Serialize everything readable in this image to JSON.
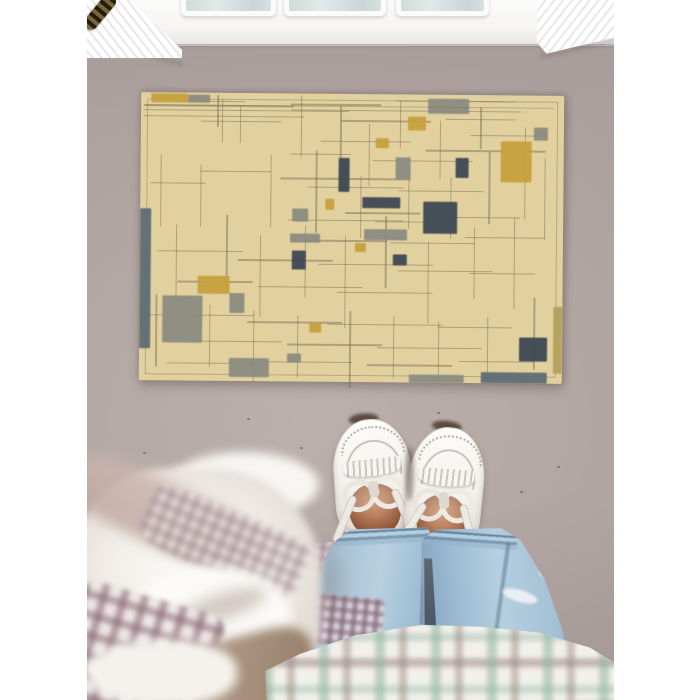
{
  "scene": {
    "description": "Top-down photo: person wearing white leather boat shoes with bow laces and rolled light-blue jeans stands on a taupe floor before a tan Mondrian-style area rug with gray, navy and mustard blocks; a white paneled door with glass panes and fluted casing is at top; a blurred white duvet with mauve plaid sits at bottom-left and a white/teal/brown plaid fabric drapes across the bottom.",
    "visible_text": "none"
  },
  "palette": {
    "margin_white": "#ffffff",
    "floor": "#b5a9a6",
    "floor_dark": "#aba09d",
    "door_white": "#fbfbfa",
    "glass": "#cfdbda",
    "hinge_brass": "#7a6636",
    "rug_tan": "#e2d19f",
    "rug_line": "#7a6f54",
    "mustard": "#c7a13d",
    "gray": "#8b8c81",
    "navy": "#3e4955",
    "slate": "#5e6c74",
    "khaki": "#b5a15e",
    "denim_light": "#b8d0e0",
    "denim_dark": "#7d9cb8",
    "skin": "#b67f5d",
    "shoe_white": "#f5f3ef",
    "blanket_white": "#f6f4f1",
    "blanket_mauve": "#c8b2ab",
    "plaid_teal": "#8fb4a1",
    "plaid_brown": "#96807c",
    "gingham_mauve": "#987686"
  },
  "door": {
    "panes": [
      {
        "x": 100,
        "w": 83
      },
      {
        "x": 203,
        "w": 90
      },
      {
        "x": 315,
        "w": 81
      }
    ]
  },
  "rug": {
    "x": 53,
    "y": 94,
    "w": 423,
    "h": 288,
    "blocks": [
      {
        "x": 10,
        "y": 1,
        "w": 37,
        "h": 9,
        "c": "m"
      },
      {
        "x": 47,
        "y": 2,
        "w": 22,
        "h": 8,
        "c": "g"
      },
      {
        "x": 287,
        "y": 4,
        "w": 41,
        "h": 15,
        "c": "g"
      },
      {
        "x": 267,
        "y": 22,
        "w": 18,
        "h": 14,
        "c": "m"
      },
      {
        "x": 393,
        "y": 32,
        "w": 14,
        "h": 13,
        "c": "g"
      },
      {
        "x": 360,
        "y": 46,
        "w": 31,
        "h": 41,
        "c": "m"
      },
      {
        "x": 235,
        "y": 44,
        "w": 13,
        "h": 10,
        "c": "m"
      },
      {
        "x": 198,
        "y": 64,
        "w": 11,
        "h": 34,
        "c": "n"
      },
      {
        "x": 255,
        "y": 63,
        "w": 15,
        "h": 22,
        "c": "g"
      },
      {
        "x": 315,
        "y": 63,
        "w": 13,
        "h": 20,
        "c": "n"
      },
      {
        "x": 222,
        "y": 103,
        "w": 38,
        "h": 11,
        "c": "n"
      },
      {
        "x": 283,
        "y": 107,
        "w": 34,
        "h": 32,
        "c": "n"
      },
      {
        "x": 185,
        "y": 105,
        "w": 9,
        "h": 11,
        "c": "m"
      },
      {
        "x": 152,
        "y": 115,
        "w": 16,
        "h": 13,
        "c": "g"
      },
      {
        "x": 150,
        "y": 140,
        "w": 30,
        "h": 9,
        "c": "g"
      },
      {
        "x": 224,
        "y": 135,
        "w": 43,
        "h": 11,
        "c": "g"
      },
      {
        "x": 152,
        "y": 157,
        "w": 14,
        "h": 19,
        "c": "n"
      },
      {
        "x": 215,
        "y": 149,
        "w": 11,
        "h": 9,
        "c": "m"
      },
      {
        "x": 253,
        "y": 160,
        "w": 14,
        "h": 11,
        "c": "n"
      },
      {
        "x": 58,
        "y": 183,
        "w": 32,
        "h": 18,
        "c": "m"
      },
      {
        "x": 90,
        "y": 200,
        "w": 15,
        "h": 20,
        "c": "g"
      },
      {
        "x": 23,
        "y": 203,
        "w": 40,
        "h": 47,
        "c": "g"
      },
      {
        "x": 170,
        "y": 229,
        "w": 12,
        "h": 10,
        "c": "m"
      },
      {
        "x": 380,
        "y": 242,
        "w": 28,
        "h": 24,
        "c": "n"
      },
      {
        "x": 148,
        "y": 260,
        "w": 14,
        "h": 9,
        "c": "g"
      },
      {
        "x": 90,
        "y": 265,
        "w": 40,
        "h": 19,
        "c": "g"
      },
      {
        "x": 0,
        "y": 116,
        "w": 11,
        "h": 140,
        "c": "s"
      },
      {
        "x": 414,
        "y": 211,
        "w": 9,
        "h": 67,
        "c": "k"
      },
      {
        "x": 342,
        "y": 277,
        "w": 66,
        "h": 11,
        "c": "s"
      },
      {
        "x": 270,
        "y": 280,
        "w": 55,
        "h": 8,
        "c": "g"
      }
    ],
    "h_lines": [
      [
        3,
        12,
        150
      ],
      [
        3,
        17,
        205
      ],
      [
        3,
        23,
        160
      ],
      [
        34,
        8,
        70
      ],
      [
        150,
        10,
        90
      ],
      [
        255,
        6,
        120
      ],
      [
        150,
        16,
        230
      ],
      [
        60,
        28,
        80
      ],
      [
        200,
        26,
        90
      ],
      [
        305,
        24,
        70
      ],
      [
        330,
        40,
        70
      ],
      [
        180,
        47,
        90
      ],
      [
        285,
        55,
        120
      ],
      [
        150,
        60,
        60
      ],
      [
        232,
        66,
        100
      ],
      [
        60,
        78,
        70
      ],
      [
        140,
        84,
        130
      ],
      [
        10,
        90,
        55
      ],
      [
        168,
        93,
        95
      ],
      [
        258,
        96,
        85
      ],
      [
        205,
        118,
        75
      ],
      [
        148,
        126,
        115
      ],
      [
        235,
        127,
        65
      ],
      [
        305,
        122,
        75
      ],
      [
        152,
        146,
        95
      ],
      [
        250,
        148,
        85
      ],
      [
        325,
        142,
        80
      ],
      [
        18,
        158,
        85
      ],
      [
        98,
        166,
        95
      ],
      [
        178,
        170,
        115
      ],
      [
        258,
        176,
        95
      ],
      [
        330,
        178,
        65
      ],
      [
        38,
        188,
        75
      ],
      [
        118,
        193,
        105
      ],
      [
        198,
        198,
        95
      ],
      [
        10,
        222,
        105
      ],
      [
        108,
        228,
        95
      ],
      [
        188,
        230,
        115
      ],
      [
        298,
        232,
        75
      ],
      [
        58,
        248,
        85
      ],
      [
        148,
        250,
        95
      ],
      [
        238,
        253,
        105
      ],
      [
        28,
        270,
        95
      ],
      [
        128,
        268,
        85
      ],
      [
        228,
        270,
        85
      ],
      [
        320,
        266,
        75
      ]
    ],
    "v_lines": [
      [
        76,
        2,
        32
      ],
      [
        81,
        6,
        44
      ],
      [
        99,
        12,
        38
      ],
      [
        160,
        2,
        62
      ],
      [
        199,
        12,
        52
      ],
      [
        228,
        30,
        62
      ],
      [
        259,
        6,
        48
      ],
      [
        299,
        26,
        58
      ],
      [
        339,
        12,
        42
      ],
      [
        20,
        62,
        72
      ],
      [
        60,
        72,
        62
      ],
      [
        130,
        62,
        72
      ],
      [
        175,
        57,
        82
      ],
      [
        220,
        82,
        62
      ],
      [
        268,
        62,
        72
      ],
      [
        310,
        82,
        62
      ],
      [
        348,
        57,
        72
      ],
      [
        384,
        32,
        92
      ],
      [
        404,
        62,
        82
      ],
      [
        36,
        132,
        82
      ],
      [
        86,
        122,
        72
      ],
      [
        120,
        142,
        82
      ],
      [
        165,
        132,
        72
      ],
      [
        205,
        142,
        92
      ],
      [
        245,
        122,
        72
      ],
      [
        288,
        147,
        82
      ],
      [
        334,
        132,
        72
      ],
      [
        374,
        122,
        92
      ],
      [
        16,
        202,
        72
      ],
      [
        70,
        212,
        62
      ],
      [
        114,
        217,
        72
      ],
      [
        158,
        222,
        62
      ],
      [
        210,
        217,
        77
      ],
      [
        254,
        222,
        62
      ],
      [
        299,
        227,
        62
      ],
      [
        348,
        222,
        57
      ],
      [
        394,
        202,
        72
      ]
    ]
  },
  "floor_specks": [
    [
      56,
      452
    ],
    [
      88,
      470
    ],
    [
      213,
      447
    ],
    [
      281,
      476
    ],
    [
      433,
      491
    ],
    [
      350,
      412
    ],
    [
      160,
      418
    ],
    [
      470,
      466
    ]
  ],
  "blanket_parts": [
    {
      "n": "shadow-on-floor",
      "l": 218,
      "t": 60,
      "w": 60,
      "h": 150,
      "r": 0,
      "rad": "50%",
      "bg": "radial-gradient(50% 50% at 50% 50%, rgba(130,115,108,.45), rgba(130,115,108,0) 70%)",
      "blur": 9,
      "op": 1
    },
    {
      "n": "top-roll",
      "l": 88,
      "t": 4,
      "w": 150,
      "h": 66,
      "r": 0,
      "rad": "50%",
      "bg": "#f8f6f3",
      "blur": 5,
      "op": 1
    },
    {
      "n": "main-mass",
      "l": -10,
      "t": 20,
      "w": 250,
      "h": 240,
      "r": 0,
      "rad": "40% 45% 35% 40%",
      "bg": "radial-gradient(55% 50% at 48% 42%, #fcfbf9, #f1ede8 60%, #e2dbd4)",
      "blur": 4,
      "op": 1
    },
    {
      "n": "mauve-band",
      "l": -14,
      "t": 36,
      "w": 200,
      "h": 64,
      "r": 25,
      "rad": "30%",
      "bg": "linear-gradient(#cdb7b0,#bfa89f)",
      "blur": 7,
      "op": 0.85
    },
    {
      "n": "gingham-band",
      "l": 60,
      "t": 62,
      "w": 168,
      "h": 64,
      "r": 23,
      "rad": "20%",
      "bg": "repeating-linear-gradient(90deg, rgba(135,105,118,.5) 0 6px, rgba(0,0,0,0) 6px 13px), repeating-linear-gradient(0deg, rgba(135,105,118,.45) 0 6px, rgba(0,0,0,0) 6px 13px), linear-gradient(#eee8e5,#eee8e5)",
      "blur": 3,
      "op": 0.8
    },
    {
      "n": "fold-highlight",
      "l": 50,
      "t": 118,
      "w": 160,
      "h": 96,
      "r": 0,
      "rad": "50%",
      "bg": "#fbfaf7",
      "blur": 5,
      "op": 1
    },
    {
      "n": "fold-shadow",
      "l": 92,
      "t": 146,
      "w": 96,
      "h": 26,
      "r": -18,
      "rad": "50%",
      "bg": "#c9beb5",
      "blur": 7,
      "op": 0.8
    },
    {
      "n": "burgundy-plaid",
      "l": -16,
      "t": 148,
      "w": 150,
      "h": 118,
      "r": 16,
      "rad": "12%",
      "bg": "repeating-linear-gradient(90deg, rgba(125,88,104,.55) 0 8px, rgba(0,0,0,0) 8px 20px), repeating-linear-gradient(0deg, rgba(125,88,104,.5) 0 8px, rgba(0,0,0,0) 8px 20px), linear-gradient(#ece5e4,#ece5e4)",
      "blur": 2.5,
      "op": 0.92
    },
    {
      "n": "tan-strip",
      "l": 108,
      "t": 186,
      "w": 128,
      "h": 78,
      "r": -14,
      "rad": "30%",
      "bg": "linear-gradient(100deg,#b39c86,#937b66)",
      "blur": 5,
      "op": 0.95
    },
    {
      "n": "white-bottom",
      "l": 6,
      "t": 192,
      "w": 150,
      "h": 66,
      "r": 0,
      "rad": "45%",
      "bg": "#f5f2ee",
      "blur": 5,
      "op": 1
    }
  ]
}
